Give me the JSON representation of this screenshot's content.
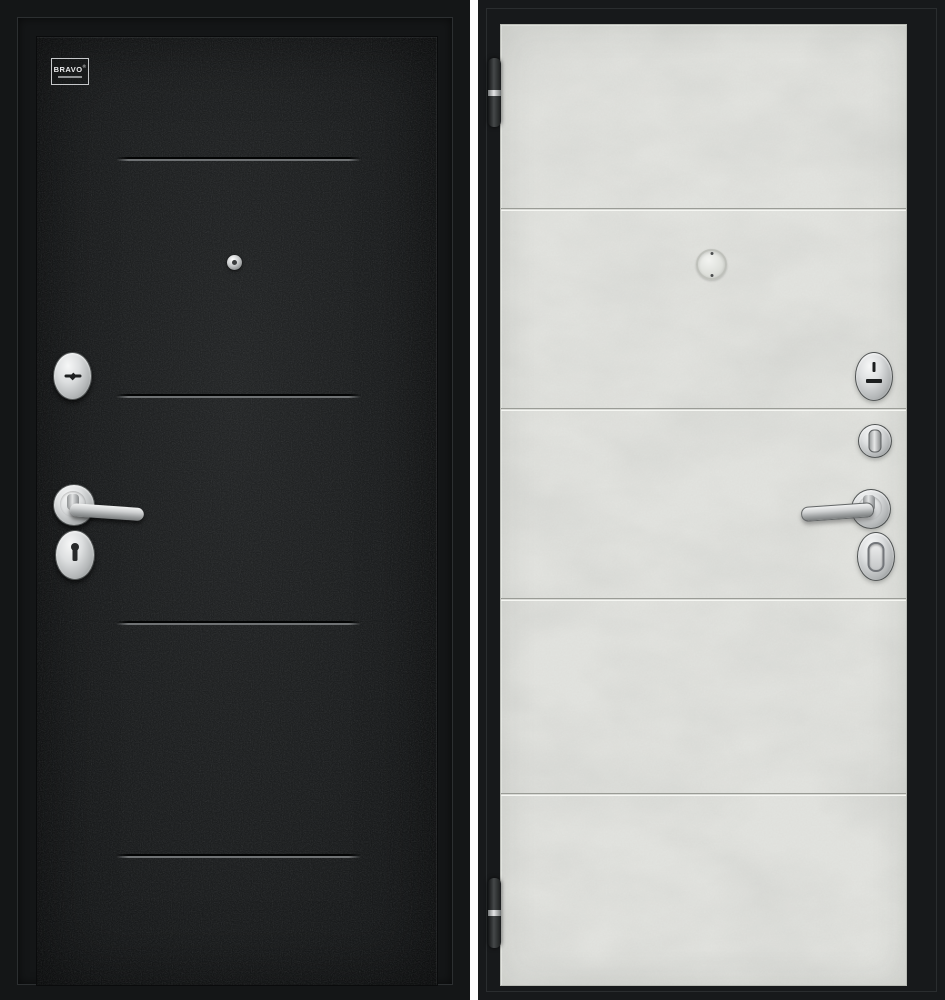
{
  "product": {
    "brand": {
      "name": "BRAVO",
      "mark": "®"
    },
    "exterior_panel": {
      "side": "exterior",
      "finish_color": "#1d1f20",
      "frame_color": "#141617",
      "groove_count": 4,
      "hardware": [
        "peephole",
        "cylinder-escutcheon",
        "lever-handle",
        "keyhole-escutcheon"
      ]
    },
    "interior_panel": {
      "side": "interior",
      "finish_color": "#e2e3df",
      "frame_color": "#17191b",
      "groove_count": 4,
      "hardware": [
        "hinge-top",
        "hinge-bottom",
        "peephole",
        "cylinder-escutcheon",
        "thumbturn",
        "lever-handle",
        "keyhole-escutcheon"
      ]
    },
    "hardware_finish_color": "#c9cbcc",
    "divider_color": "#fdfdfd"
  }
}
